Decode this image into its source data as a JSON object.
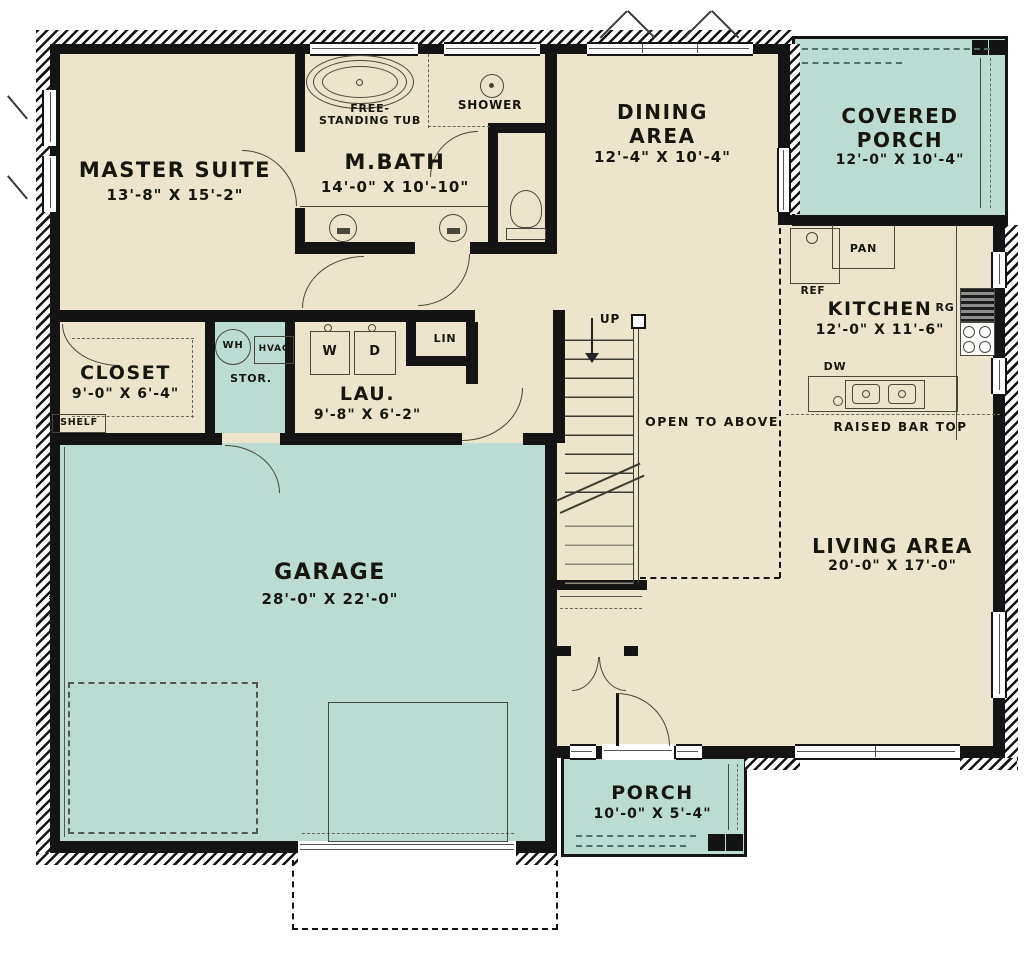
{
  "colors": {
    "wall": "#141414",
    "cream": "#ECE4CC",
    "teal": "#BBDBD3",
    "line": "#4a473c",
    "teal_line": "#4e6e67"
  },
  "rooms": {
    "master": {
      "name": "MASTER SUITE",
      "dims": "13'-8\" X 15'-2\""
    },
    "mbath": {
      "name": "M.BATH",
      "dims": "14'-0\" X 10'-10\""
    },
    "dining": {
      "line1": "DINING",
      "line2": "AREA",
      "dims": "12'-4\" X 10'-4\""
    },
    "covered_porch": {
      "line1": "COVERED",
      "line2": "PORCH",
      "dims": "12'-0\" X 10'-4\""
    },
    "kitchen": {
      "name": "KITCHEN",
      "dims": "12'-0\" X 11'-6\""
    },
    "closet": {
      "name": "CLOSET",
      "dims": "9'-0\" X 6'-4\""
    },
    "laundry": {
      "name": "LAU.",
      "dims": "9'-8\" X 6'-2\""
    },
    "garage": {
      "name": "GARAGE",
      "dims": "28'-0\" X 22'-0\""
    },
    "living": {
      "name": "LIVING AREA",
      "dims": "20'-0\" X 17'-0\""
    },
    "porch": {
      "name": "PORCH",
      "dims": "10'-0\" X 5'-4\""
    }
  },
  "labels": {
    "free_tub_line1": "FREE-",
    "free_tub_line2": "STANDING TUB",
    "shower": "SHOWER",
    "shelf": "SHELF",
    "stor": "STOR.",
    "wh": "WH",
    "hvac": "HVAC",
    "washer": "W",
    "dryer": "D",
    "lin": "LIN",
    "up": "UP",
    "open_to_above": "OPEN TO ABOVE",
    "pan": "PAN",
    "ref": "REF",
    "range": "RG",
    "dw": "DW",
    "raised_bar": "RAISED BAR TOP",
    "garage_depth": "20'-0\""
  }
}
